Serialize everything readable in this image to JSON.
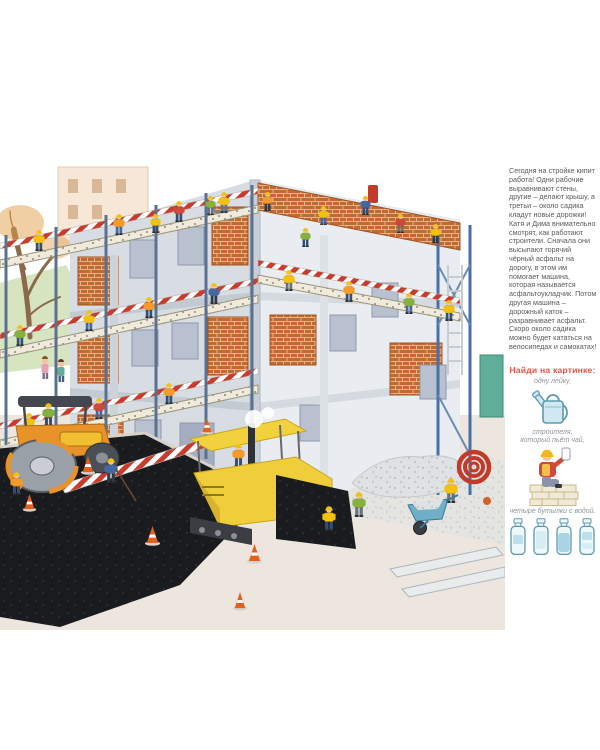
{
  "page": {
    "background": "#ffffff"
  },
  "story": {
    "text": "Сегодня на стройке кипит работа! Одни рабочие выравнивают стены, другие – делают крышу, а третьи – около садика кладут новые дорожки! Катя и Дима внимательно смотрят, как работают строители. Сначала они высыпают горячий чёрный асфальт на дорогу, в этом им помогает машина, которая называется асфальтоукладчик. Потом другая машина – дорожный каток – разравнивает асфальт. Скоро около садика можно будет кататься на велосипедах и самокатах!"
  },
  "find_section": {
    "heading": "Найди на картинке:",
    "items": [
      {
        "caption": "одну лейку,",
        "icon": "watering-can-icon"
      },
      {
        "caption": "строителя,\nкоторый пьёт чай,",
        "icon": "builder-drinking-tea-icon"
      },
      {
        "caption": "четыре бутылки с водой.",
        "icon": "water-bottles-icon",
        "count": 4
      }
    ]
  },
  "scene": {
    "elements": [
      "construction-building",
      "scaffolding",
      "workers-in-helmets",
      "road-roller",
      "asphalt-paver",
      "fresh-black-asphalt",
      "traffic-cones",
      "bare-tree",
      "gravel-pile",
      "wheelbarrow",
      "red-pipe-coil",
      "curb-stones",
      "children-watching",
      "rooftop-workers"
    ]
  },
  "palette": {
    "heading_red": "#e0544a",
    "body_text": "#5a5a5a",
    "caption_gray": "#8f959c",
    "brick": "#c2692f",
    "scaffold_blue": "#4a6fa5",
    "stripe_red": "#c93b2e",
    "machine_yellow": "#f0cd3a",
    "roller_orange": "#e8922a",
    "asphalt_black": "#1a1b1e",
    "icon_outline_blue": "#5d9ab0",
    "icon_fill_blue": "#e8f3f8"
  }
}
